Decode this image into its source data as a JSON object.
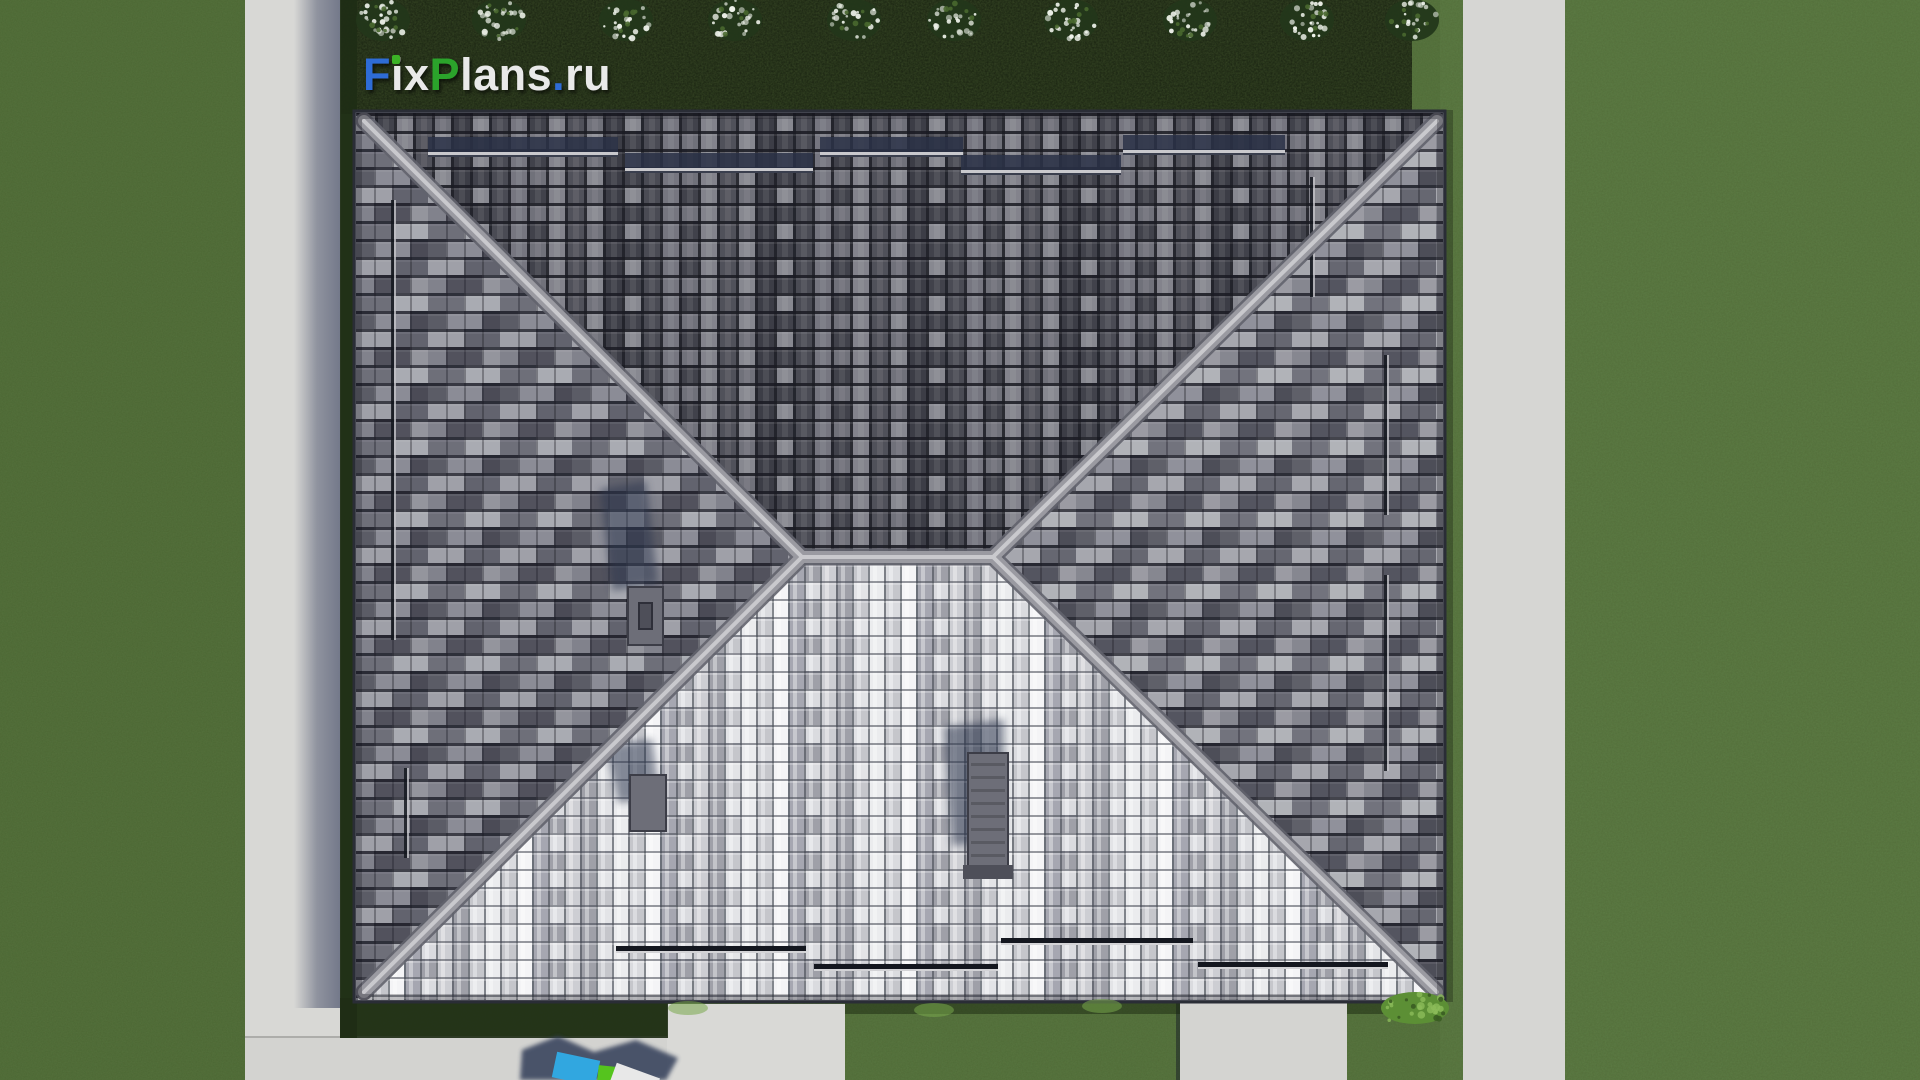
{
  "page": {
    "width": 1920,
    "height": 1080
  },
  "watermark": {
    "text": "FixPlans.ru",
    "parts": [
      {
        "text": "F",
        "color": "#2e6cd6"
      },
      {
        "text": "i",
        "color": "#e9e9e9",
        "dot_color": "#3cb226"
      },
      {
        "text": "x",
        "color": "#e9e9e9"
      },
      {
        "text": "P",
        "color": "#2ba32b"
      },
      {
        "text": "lans",
        "color": "#e9e9e9"
      },
      {
        "text": ".",
        "color": "#2e6cd6"
      },
      {
        "text": "ru",
        "color": "#e9e9e9"
      }
    ]
  },
  "scene": {
    "type": "3d-architectural-render",
    "view": "top-down aerial view of a detached house hip roof with tiled surfaces, lawn, concrete walkways and flowering hedge",
    "colors": {
      "grass": "#51703a",
      "grass_light": "#5a7a42",
      "grass_dark": "#47632f",
      "hedge_bed": "#131c0c",
      "shadow_grass": "#1f2d15",
      "concrete": "#d8d8d5",
      "concrete_shadow": "#2b3454",
      "roof_base": "#5a5b65",
      "ridge": "#9a9aa1",
      "ridge_highlight": "#c9c9cd",
      "ridge_edge": "#62636d",
      "fascia": "#2a2d36",
      "chimney": "#6d6e78",
      "chimney_shadow": "#2e3850",
      "snow_guard": "#14171f",
      "snow_guard_rail": "#c9c9cd",
      "bush_foliage": "#23371a",
      "bush_flowers": "#eef2ea",
      "shrub": "#5c8f35",
      "shrub_light": "#8cbb5a",
      "shrub_dark": "#3a5c22",
      "tuft": "#79a74c",
      "furniture_blue": "#31a7e0",
      "furniture_green": "#55c41e",
      "furniture_white": "#e8e8e8",
      "furniture_shadow": "#323d58"
    },
    "roof": {
      "left": 356,
      "top": 113,
      "right": 1443,
      "bottom": 1000,
      "ridge_x1": 802,
      "ridge_x2": 993,
      "ridge_y": 557
    },
    "hardscape": [
      {
        "name": "walkway-west",
        "x": 245,
        "y": 0,
        "w": 96,
        "h": 1080,
        "tint": "#d8d8d5"
      },
      {
        "name": "walkway-east",
        "x": 1463,
        "y": 0,
        "w": 102,
        "h": 1080,
        "tint": "#d6d6d3"
      },
      {
        "name": "terrace-south",
        "x": 245,
        "y": 1036,
        "w": 441,
        "h": 44,
        "tint": "#d3d3d0",
        "edge_top": true
      },
      {
        "name": "porch-pad-south",
        "x": 667,
        "y": 1004,
        "w": 178,
        "h": 76,
        "tint": "#d9d9d6"
      },
      {
        "name": "pad-southeast",
        "x": 1180,
        "y": 1000,
        "w": 167,
        "h": 80,
        "tint": "#d4d4d1",
        "edge_left": true
      }
    ],
    "snow_guards": {
      "top": [
        [
          428,
          152,
          190
        ],
        [
          625,
          168,
          188
        ],
        [
          820,
          152,
          143
        ],
        [
          961,
          170,
          160
        ],
        [
          1123,
          150,
          162
        ]
      ],
      "bottom": [
        [
          616,
          946,
          190
        ],
        [
          814,
          964,
          184
        ],
        [
          1001,
          938,
          192
        ],
        [
          1198,
          962,
          190
        ]
      ],
      "left": [
        [
          391,
          200,
          440
        ],
        [
          404,
          768,
          90
        ]
      ],
      "right": [
        [
          1384,
          355,
          160
        ],
        [
          1384,
          575,
          196
        ],
        [
          1310,
          177,
          120
        ]
      ]
    },
    "roof_objects": [
      {
        "name": "roof-vent-west",
        "x": 628,
        "y": 587,
        "w": 35,
        "h": 58,
        "inner": true,
        "shadow": "600,489 646,481 658,583 612,591"
      },
      {
        "name": "roof-vent-south",
        "x": 630,
        "y": 775,
        "w": 36,
        "h": 56,
        "inner": false,
        "shadow": "606,746 652,739 660,797 618,803"
      },
      {
        "name": "chimney-south",
        "x": 968,
        "y": 753,
        "w": 40,
        "h": 120,
        "ribbed": true,
        "shadow": "944,727 1004,719 1006,838 952,846"
      }
    ],
    "hedge": {
      "x": 340,
      "y": 0,
      "w": 1072,
      "h": 114
    },
    "bushes": {
      "cy": 20,
      "rx": 27,
      "ry": 21,
      "xs": [
        383,
        499,
        626,
        735,
        854,
        954,
        1071,
        1190,
        1307,
        1412
      ]
    },
    "shrubs": [
      {
        "cx": 1415,
        "cy": 1008,
        "rx": 34,
        "ry": 16
      }
    ],
    "tufts": [
      [
        688,
        1008
      ],
      [
        934,
        1010
      ],
      [
        1102,
        1006
      ]
    ],
    "furniture": {
      "shadow_poly": "522,1050 558,1036 594,1052 636,1040 678,1058 666,1080 520,1080",
      "items": [
        {
          "name": "patio-item-blue",
          "x": 554,
          "y": 1056,
          "w": 44,
          "h": 26,
          "rot": 12,
          "color_key": "furniture_blue"
        },
        {
          "name": "patio-item-green",
          "x": 598,
          "y": 1066,
          "w": 17,
          "h": 15,
          "rot": 6,
          "color_key": "furniture_green"
        },
        {
          "name": "patio-item-white",
          "x": 612,
          "y": 1070,
          "w": 46,
          "h": 20,
          "rot": 20,
          "color_key": "furniture_white"
        }
      ]
    }
  }
}
